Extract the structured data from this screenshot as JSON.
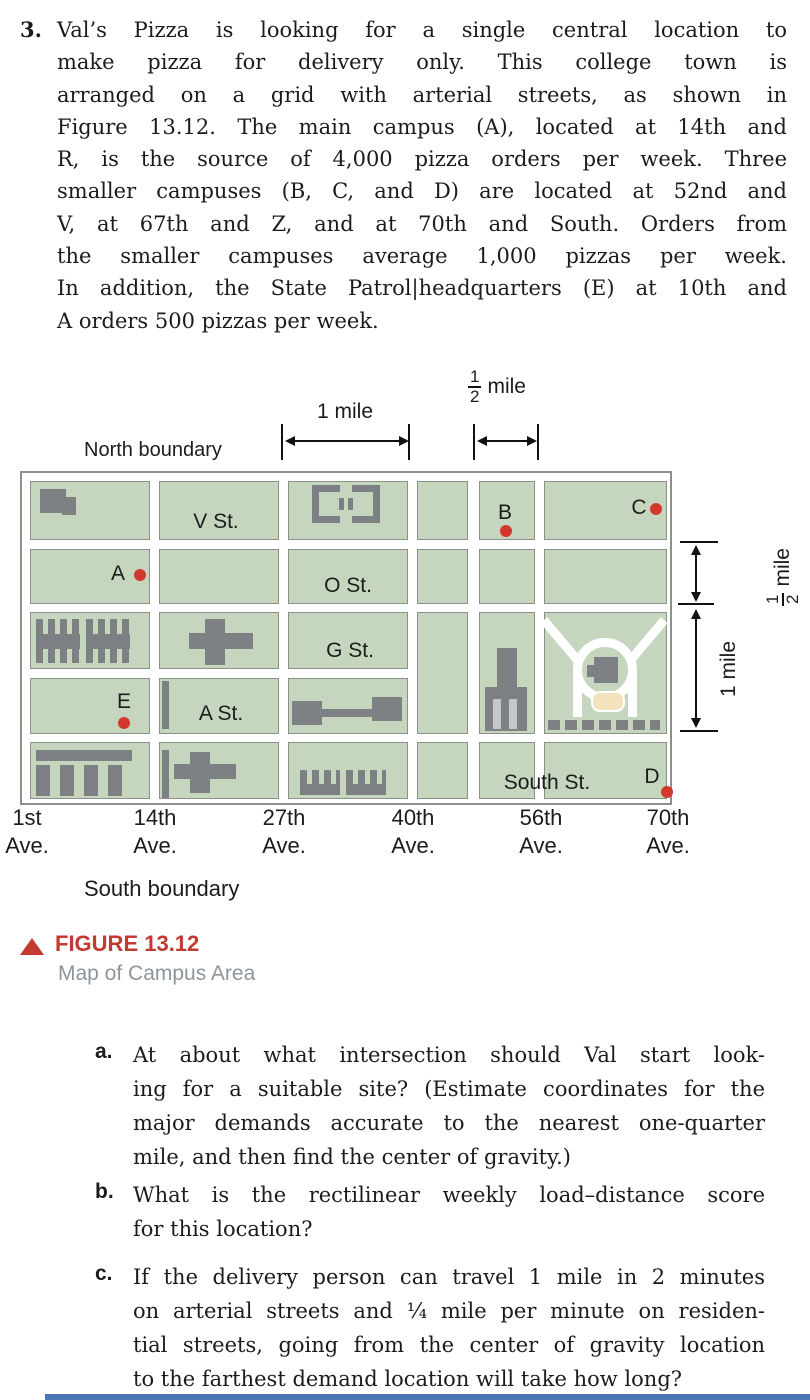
{
  "problem": {
    "number": "3.",
    "lines": [
      "Val’s Pizza is looking for a single central location to",
      "make pizza for delivery only. This college town is",
      "arranged on a grid with arterial streets, as shown in",
      "Figure 13.12. The main campus (A), located at 14th and",
      "R, is the source of 4,000 pizza orders per week. Three",
      "smaller campuses (B, C, and D) are located at 52nd and",
      "V, at 67th and Z, and at 70th and South. Orders from",
      "the smaller campuses average 1,000 pizzas per week.",
      "In addition, the State Patrol|headquarters (E) at 10th and",
      "A orders 500 pizzas per week."
    ]
  },
  "figure": {
    "north_boundary": "North boundary",
    "south_boundary": "South boundary",
    "scale_top": {
      "one_mile": "1 mile",
      "half_num": "1",
      "half_den": "2",
      "half_unit": "mile"
    },
    "scale_right": {
      "half_num": "1",
      "half_den": "2",
      "half_unit": "mile",
      "one_mile": "1 mile"
    },
    "streets": {
      "v": "V St.",
      "o": "O St.",
      "g": "G St.",
      "a": "A St.",
      "south": "South St."
    },
    "avenues": [
      {
        "name": "1st",
        "suffix": "Ave."
      },
      {
        "name": "14th",
        "suffix": "Ave."
      },
      {
        "name": "27th",
        "suffix": "Ave."
      },
      {
        "name": "40th",
        "suffix": "Ave."
      },
      {
        "name": "56th",
        "suffix": "Ave."
      },
      {
        "name": "70th",
        "suffix": "Ave."
      }
    ],
    "points": {
      "a": "A",
      "b": "B",
      "c": "C",
      "d": "D",
      "e": "E"
    },
    "colors": {
      "block_green": "#c6d6be",
      "building_gray": "#7d8184",
      "dot_red": "#d2382c",
      "street_white": "#ffffff",
      "border_gray": "#8b9189"
    }
  },
  "caption": {
    "label": "FIGURE 13.12",
    "title": "Map of Campus Area",
    "accent_red": "#c23a30",
    "title_gray": "#8d949c"
  },
  "questions": [
    {
      "letter": "a.",
      "lines": [
        "At about what intersection should Val start look-",
        "ing for a suitable site? (Estimate coordinates for the",
        "major demands accurate to the nearest one-quarter",
        "mile, and then find the center of gravity.)"
      ]
    },
    {
      "letter": "b.",
      "lines": [
        "What is the rectilinear weekly load–distance score",
        "for this location?"
      ]
    },
    {
      "letter": "c.",
      "lines": [
        "If the delivery person can travel 1 mile in 2 minutes",
        "on arterial streets and ¹⁄₄ mile per minute on residen-",
        "tial streets, going from the center of gravity location",
        "to the farthest demand location will take how long?"
      ]
    }
  ]
}
